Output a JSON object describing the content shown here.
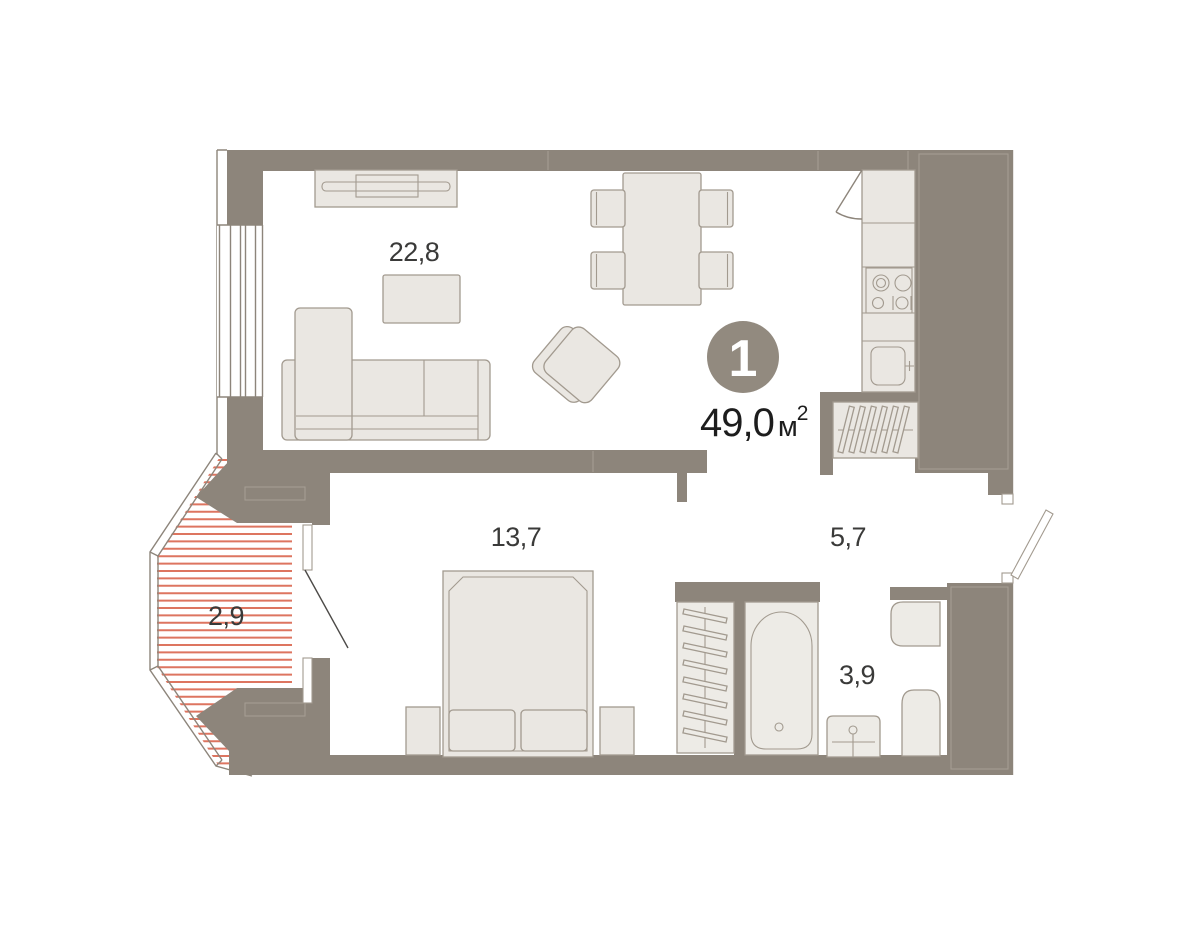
{
  "plan": {
    "badge": {
      "room_count": "1"
    },
    "area": {
      "value": "49,0",
      "unit": "м",
      "superscript": "2"
    },
    "rooms": [
      {
        "name": "living-room-kitchen",
        "area": "22,8"
      },
      {
        "name": "bedroom",
        "area": "13,7"
      },
      {
        "name": "hallway",
        "area": "5,7"
      },
      {
        "name": "bathroom",
        "area": "3,9"
      },
      {
        "name": "balcony",
        "area": "2,9"
      }
    ],
    "colors": {
      "wall": "#8d857b",
      "furniture_fill": "#eae7e2",
      "furniture_stroke": "#a29a8f",
      "fixture_fill": "#edebe6",
      "hatch": "#dd7560",
      "room_label": "#3a3a39",
      "area_text": "#1d1d1d",
      "badge_fill": "#928a7f",
      "badge_text": "#ffffff",
      "outline": "#8d857b",
      "door_line": "#4c4a47"
    }
  }
}
